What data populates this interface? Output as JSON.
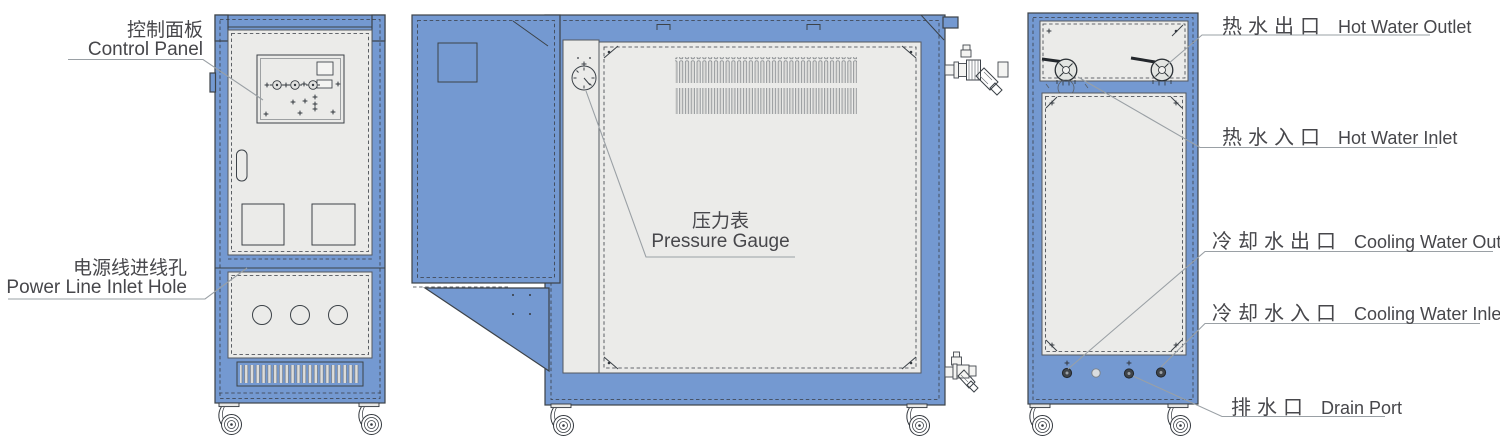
{
  "diagram": {
    "labels": {
      "control_panel": {
        "zh": "控制面板",
        "en": "Control Panel"
      },
      "power_line_inlet_hole": {
        "zh": "电源线进线孔",
        "en": "Power Line Inlet Hole"
      },
      "pressure_gauge": {
        "zh": "压力表",
        "en": "Pressure Gauge"
      },
      "hot_water_outlet": {
        "zh": "热水出口",
        "en": "Hot Water Outlet"
      },
      "hot_water_inlet": {
        "zh": "热水入口",
        "en": "Hot Water Inlet"
      },
      "cooling_water_outlet": {
        "zh": "冷却水出口",
        "en": "Cooling Water Outlet"
      },
      "cooling_water_inlet": {
        "zh": "冷却水入口",
        "en": "Cooling Water Inlet"
      },
      "drain_port": {
        "zh": "排水口",
        "en": "Drain Port"
      }
    },
    "colors": {
      "machine_blue": "#7499d1",
      "panel_gray": "#ebebe9",
      "line_dark": "#3c4248",
      "label_text": "#47474b",
      "leader_gray": "#9aa0a5"
    }
  }
}
